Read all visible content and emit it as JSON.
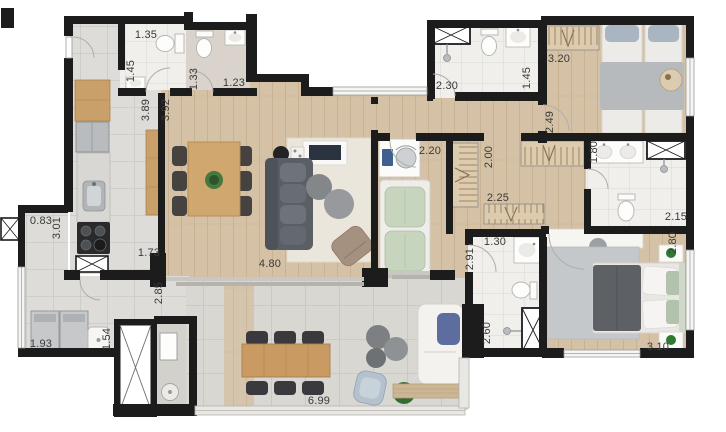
{
  "plan": {
    "type": "apartment-floor-plan",
    "unit": "m",
    "palette": {
      "wall": "#1c1c1c",
      "wood_floor": "#d5c2a6",
      "gray_tile": "#dedcd8",
      "bath_tile": "#f0efeb",
      "concrete": "#d9d7d2",
      "label_text": "#3a3a3a",
      "plant_green": "#2f7a33"
    },
    "dims": [
      {
        "name": "bathroom-1-width",
        "value": "1.35"
      },
      {
        "name": "bathroom-1-depth",
        "value": "1.45"
      },
      {
        "name": "lavatory-depth",
        "value": "1.33"
      },
      {
        "name": "lavatory-width",
        "value": "1.23"
      },
      {
        "name": "entry-gallery-length",
        "value": "3.89"
      },
      {
        "name": "living-length",
        "value": "3.92"
      },
      {
        "name": "bathroom-2-width",
        "value": "2.30"
      },
      {
        "name": "bathroom-2-depth",
        "value": "1.45"
      },
      {
        "name": "bedroom-2-width",
        "value": "3.20"
      },
      {
        "name": "bedroom-2-depth",
        "value": "2.49"
      },
      {
        "name": "office-width",
        "value": "2.20"
      },
      {
        "name": "hall-closet-depth",
        "value": "2.00"
      },
      {
        "name": "hall-closet-width",
        "value": "2.25"
      },
      {
        "name": "master-bath-depth",
        "value": "1.80"
      },
      {
        "name": "master-bath-width",
        "value": "2.15"
      },
      {
        "name": "master-bedroom-depth",
        "value": "2.80"
      },
      {
        "name": "bathroom-3-width",
        "value": "1.30"
      },
      {
        "name": "office-depth",
        "value": "2.91"
      },
      {
        "name": "bathroom-3-depth",
        "value": "2.60"
      },
      {
        "name": "master-bedroom-width",
        "value": "3.10"
      },
      {
        "name": "service-balcony-width",
        "value": "0.83"
      },
      {
        "name": "service-balcony-depth",
        "value": "3.01"
      },
      {
        "name": "kitchen-opening-width",
        "value": "1.73"
      },
      {
        "name": "living-width",
        "value": "4.80"
      },
      {
        "name": "service-passage-depth",
        "value": "2.85"
      },
      {
        "name": "laundry-width",
        "value": "1.93"
      },
      {
        "name": "laundry-depth",
        "value": "1.54"
      },
      {
        "name": "terrace-width",
        "value": "6.99"
      }
    ]
  }
}
